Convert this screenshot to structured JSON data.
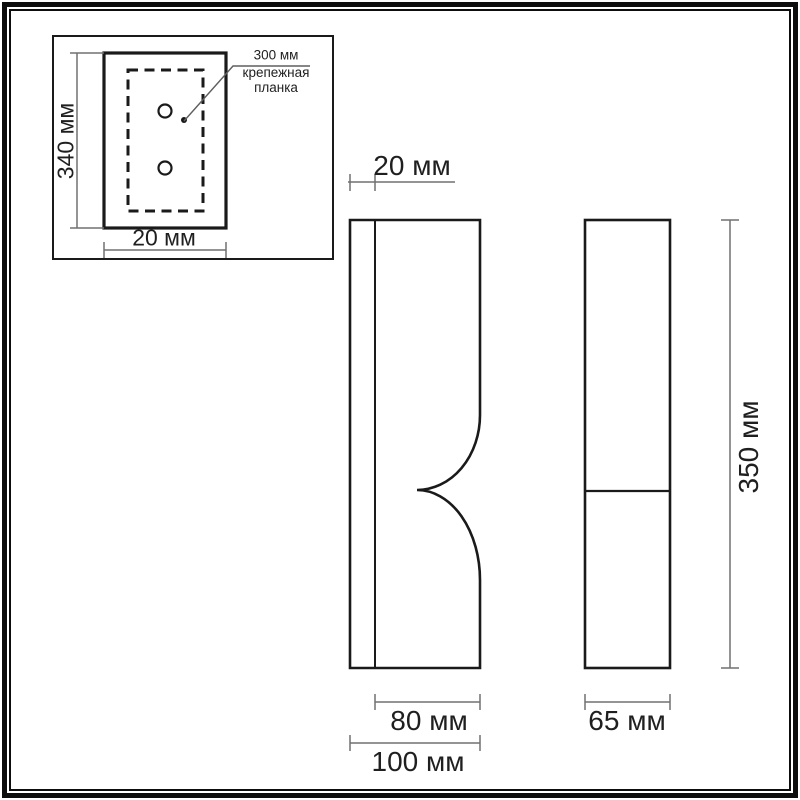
{
  "drawing": {
    "type": "product dimension drawing (wall light)",
    "inset": {
      "height_dim": "340 мм",
      "width_dim": "20 мм",
      "leader_value": "300 мм",
      "leader_caption": "крепежная\nпланка"
    },
    "side_view": {
      "top_dim": "20 мм",
      "inner_width_dim": "80 мм",
      "outer_width_dim": "100 мм"
    },
    "front_view": {
      "width_dim": "65 мм",
      "height_dim": "350 мм"
    }
  },
  "colors": {
    "outline": "#1a1a1a",
    "dimension_line": "#707070",
    "text": "#1f1f1f",
    "frame": "#0d0d0d",
    "background": "#ffffff"
  }
}
